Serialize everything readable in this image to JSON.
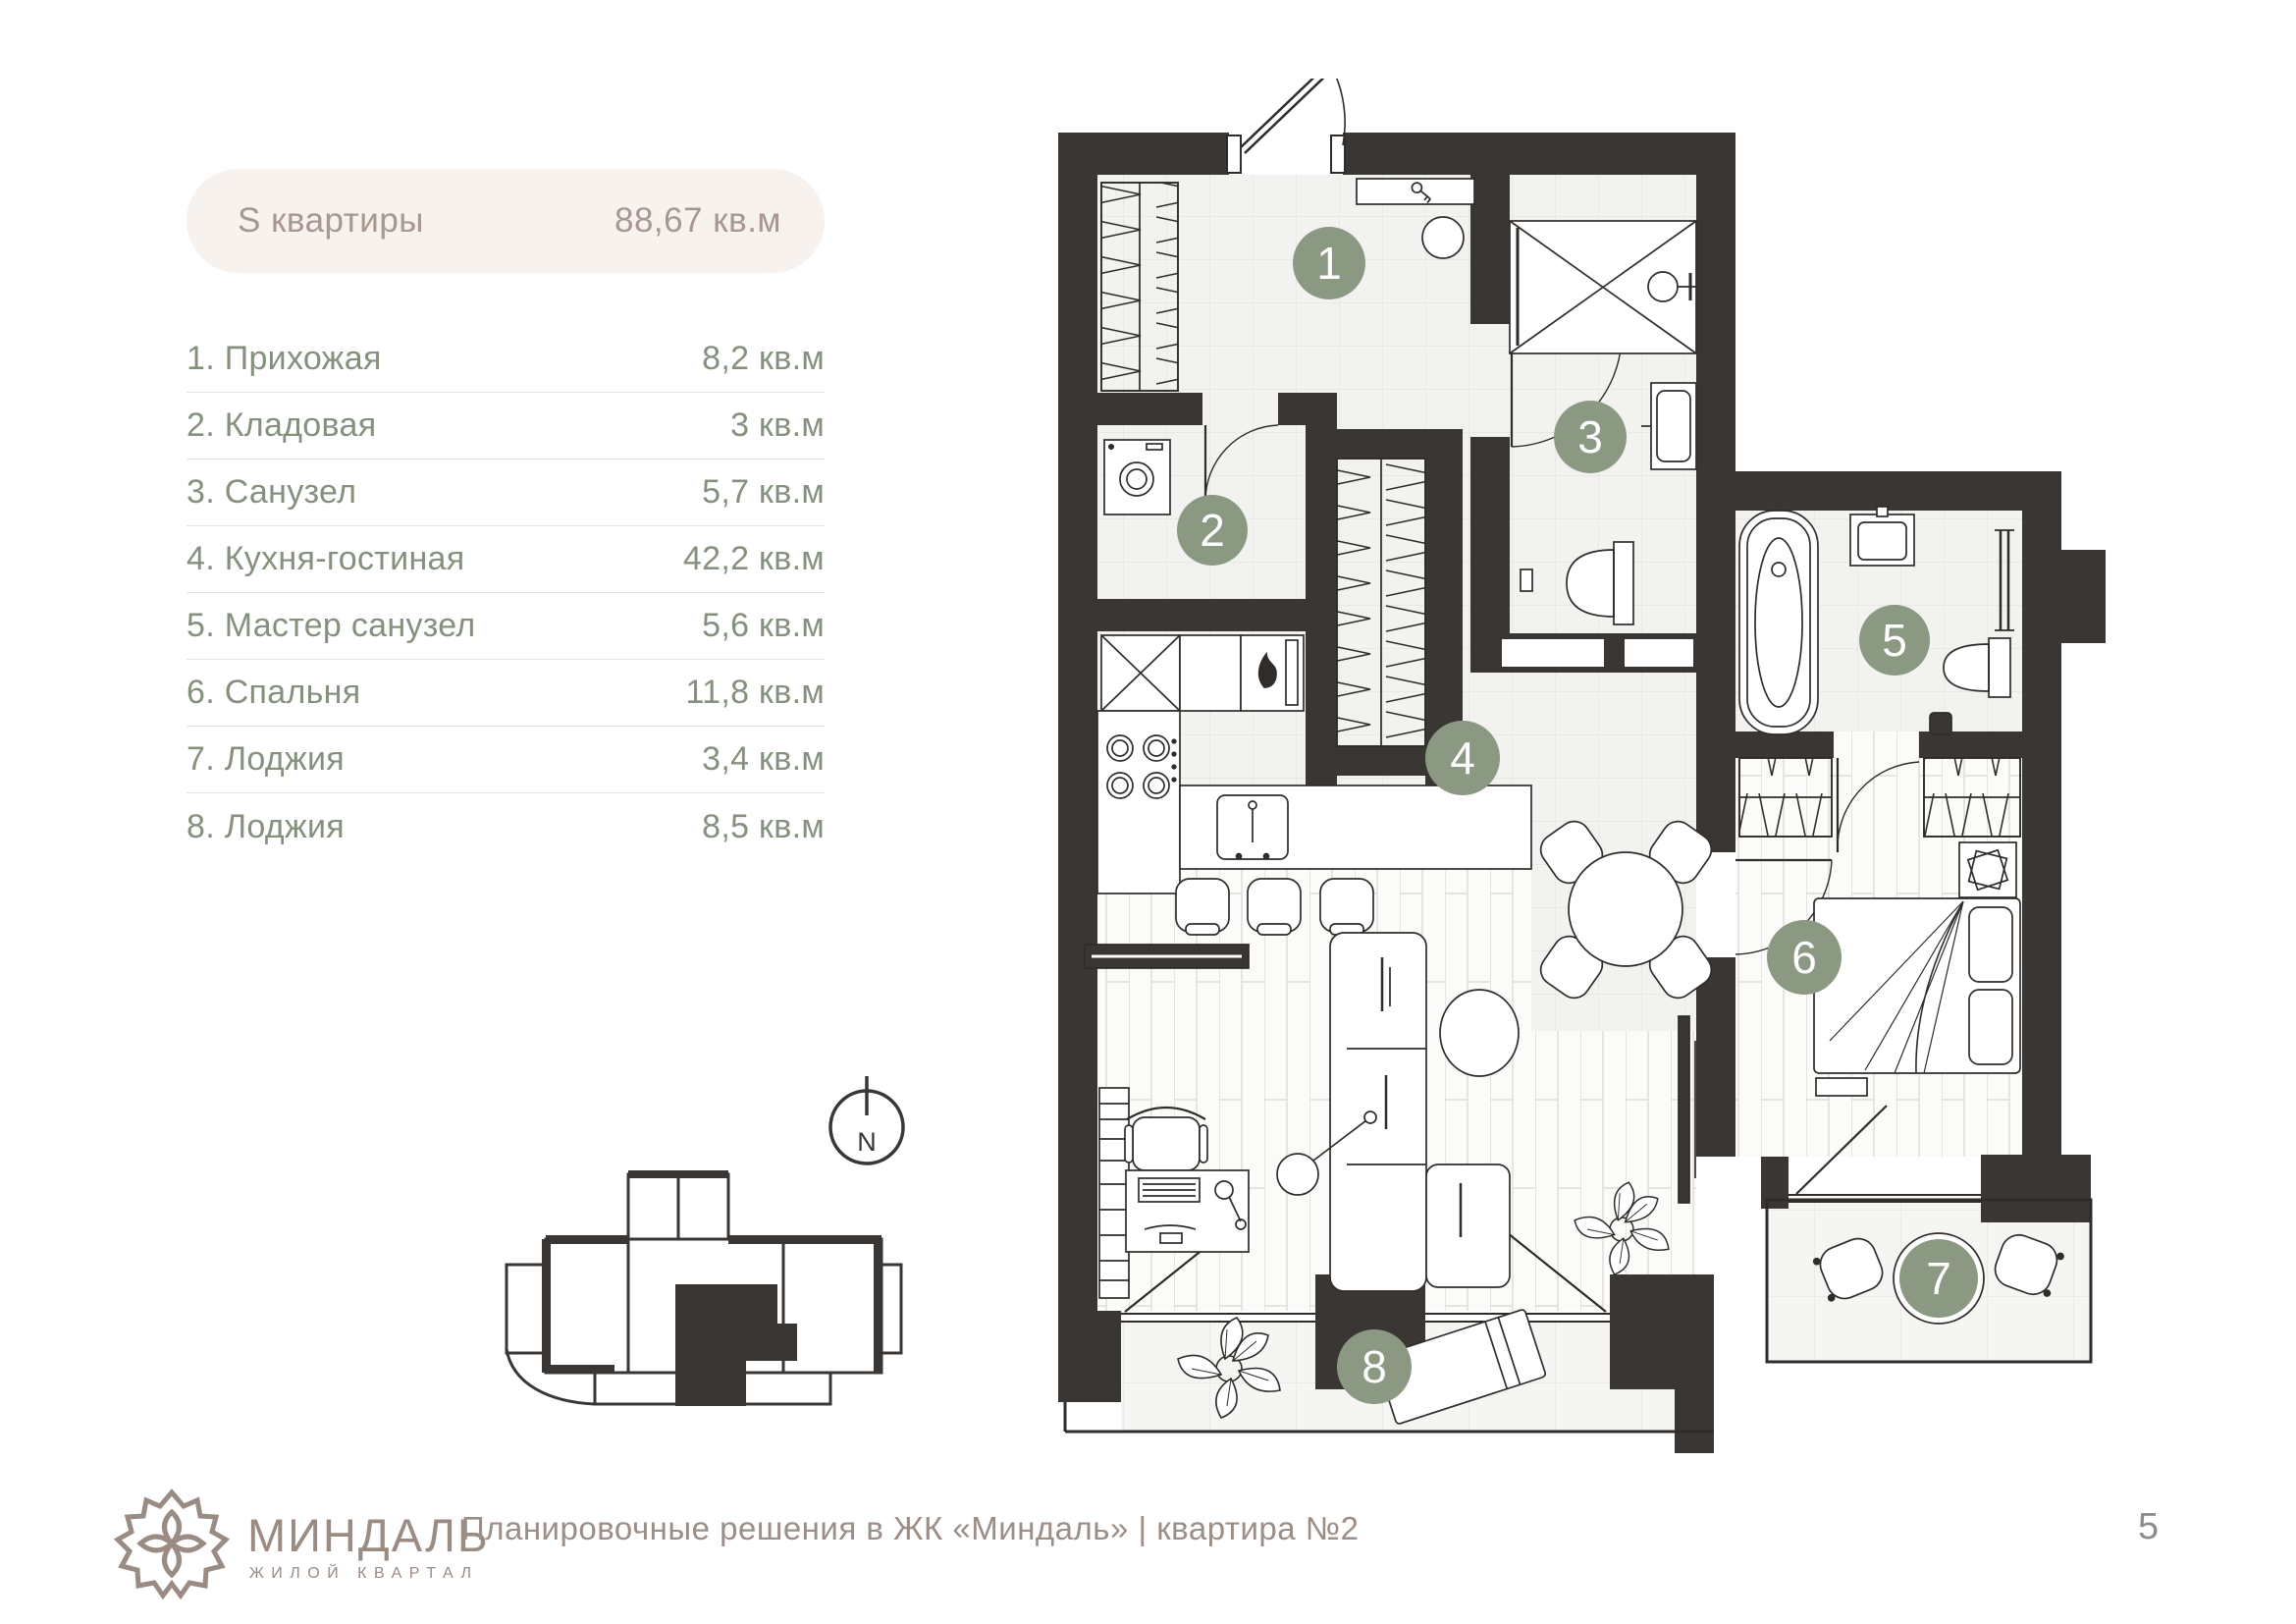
{
  "summary": {
    "label": "S квартиры",
    "value": "88,67 кв.м"
  },
  "rooms": [
    {
      "num": "1",
      "label": "1. Прихожая",
      "area": "8,2 кв.м"
    },
    {
      "num": "2",
      "label": "2. Кладовая",
      "area": "3 кв.м"
    },
    {
      "num": "3",
      "label": "3. Санузел",
      "area": "5,7 кв.м"
    },
    {
      "num": "4",
      "label": "4. Кухня-гостиная",
      "area": "42,2 кв.м"
    },
    {
      "num": "5",
      "label": "5. Мастер санузел",
      "area": "5,6 кв.м"
    },
    {
      "num": "6",
      "label": "6. Спальня",
      "area": "11,8 кв.м"
    },
    {
      "num": "7",
      "label": "7. Лоджия",
      "area": "3,4 кв.м"
    },
    {
      "num": "8",
      "label": "8. Лоджия",
      "area": "8,5 кв.м"
    }
  ],
  "compass": {
    "label": "N"
  },
  "footer": {
    "brand": "МИНДАЛЬ",
    "brand_sub": "ЖИЛОЙ КВАРТАЛ",
    "caption": "Планировочные решения в ЖК «Миндаль» | квартира №2",
    "page_number": "5"
  },
  "colors": {
    "wall": "#3a3633",
    "badge": "#8b9983",
    "pill_bg": "#f8f2ee",
    "pill_text": "#a6978f",
    "list_text": "#85917e",
    "footer_text": "#9b8e86"
  }
}
